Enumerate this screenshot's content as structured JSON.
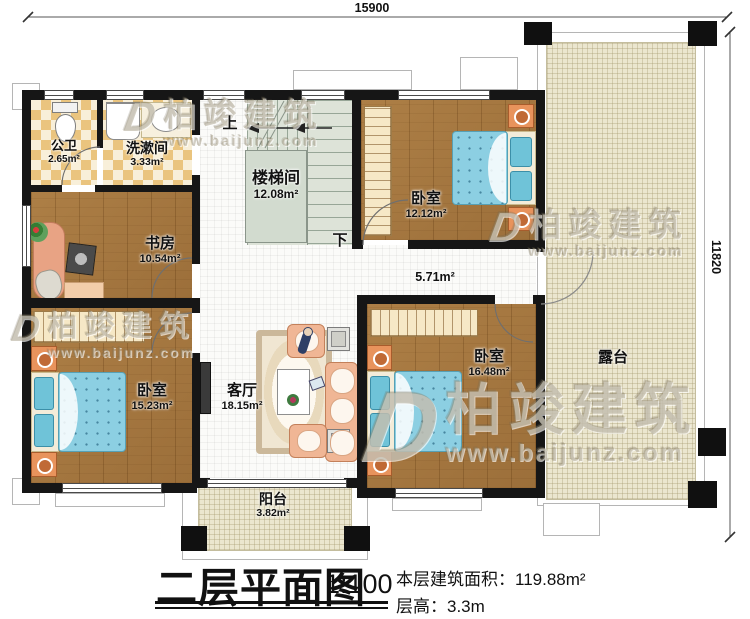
{
  "dimensions": {
    "top": "15900",
    "right": "11820"
  },
  "rooms": {
    "bathroom": {
      "name": "公卫",
      "area": "2.65m²"
    },
    "washroom": {
      "name": "洗漱间",
      "area": "3.33m²"
    },
    "study": {
      "name": "书房",
      "area": "10.54m²"
    },
    "stairwell": {
      "name": "楼梯间",
      "area": "12.08m²"
    },
    "bedroom_top": {
      "name": "卧室",
      "area": "12.12m²"
    },
    "bedroom_left": {
      "name": "卧室",
      "area": "15.23m²"
    },
    "bedroom_right": {
      "name": "卧室",
      "area": "16.48m²"
    },
    "living_room": {
      "name": "客厅",
      "area": "18.15m²"
    },
    "corridor": {
      "area": "5.71m²"
    },
    "balcony": {
      "name": "阳台",
      "area": "3.82m²"
    },
    "terrace": {
      "name": "露台"
    }
  },
  "stairs": {
    "up": "上",
    "down": "下"
  },
  "watermark": {
    "brand": "柏竣建筑",
    "url": "www.baijunz.com",
    "logo_glyph": "D"
  },
  "footer": {
    "plan_title": "二层平面图",
    "scale": "1:100",
    "area_label": "本层建筑面积：",
    "area_value": "119.88m²",
    "floor_height_label": "层高：",
    "floor_height_value": "3.3m"
  },
  "colors": {
    "wall": "#161616",
    "wood_floor": "#a87c44",
    "tile_accent": "#eac47e",
    "bed_blue": "#8ccfe2",
    "outdoor_floor": "#ebe6cf",
    "stair_gray": "#dde3d8"
  }
}
